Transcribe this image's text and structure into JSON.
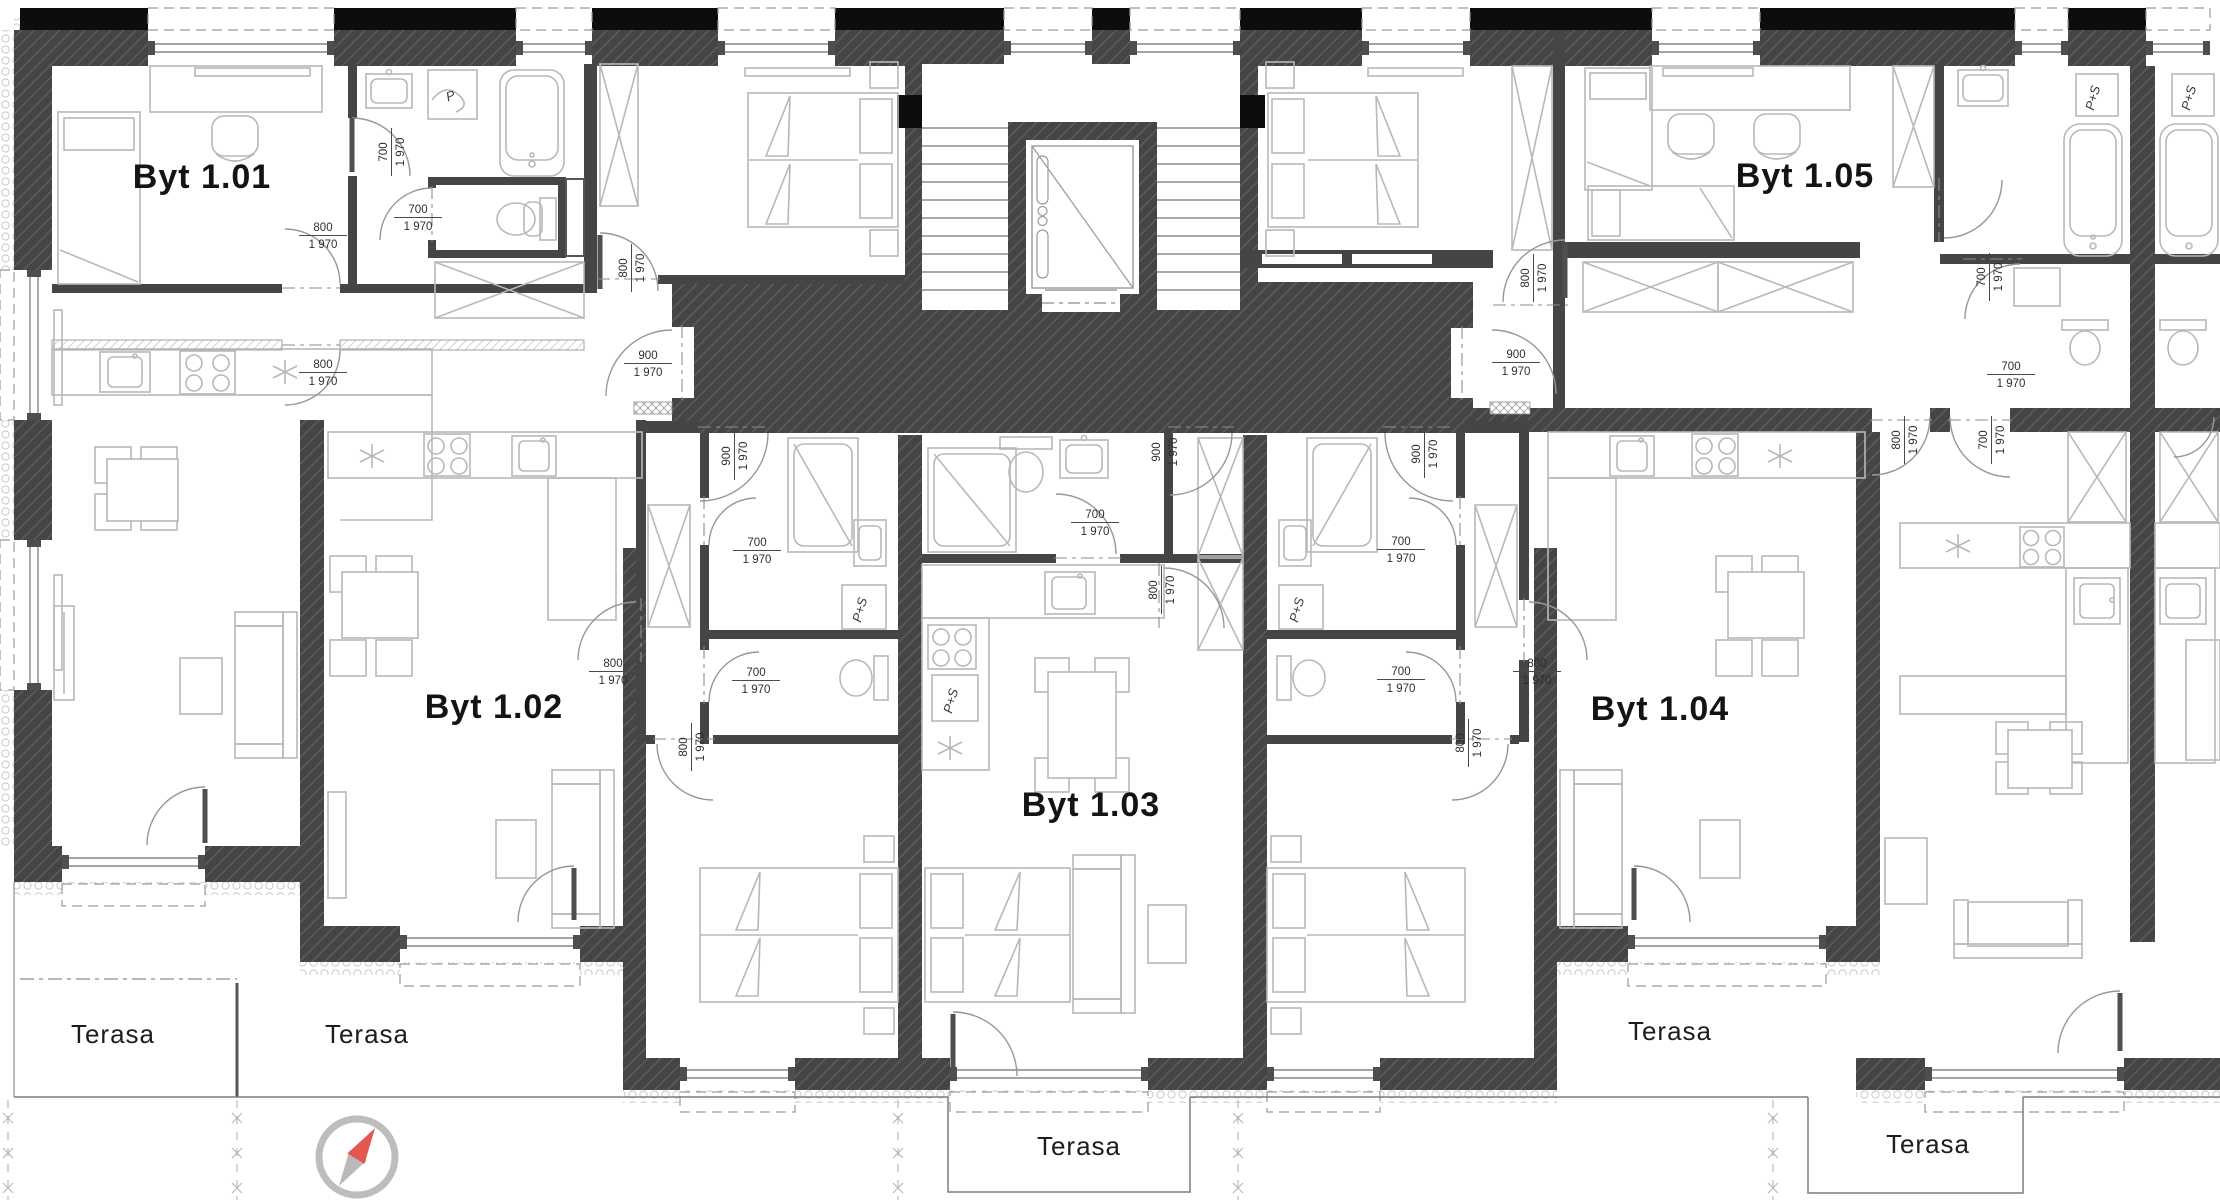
{
  "drawing": {
    "kind": "architectural floor plan",
    "floor_label": "1",
    "units": "mm"
  },
  "colors": {
    "wall_dark": "#454545",
    "wall_hatch": "#616161",
    "black_strip": "#0d0d0d",
    "thin_line": "#b8b8b8",
    "door_line": "#979797",
    "dim_text": "#2e2e2e",
    "compass_ring": "#bdbdbd",
    "compass_north": "#e2584e",
    "compass_south": "#b9b9b9"
  },
  "apartments": [
    {
      "id": "1.01",
      "label": "Byt 1.01",
      "x": 202,
      "y": 188
    },
    {
      "id": "1.02",
      "label": "Byt 1.02",
      "x": 494,
      "y": 718
    },
    {
      "id": "1.03",
      "label": "Byt 1.03",
      "x": 1091,
      "y": 816
    },
    {
      "id": "1.04",
      "label": "Byt 1.04",
      "x": 1660,
      "y": 720
    },
    {
      "id": "1.05",
      "label": "Byt 1.05",
      "x": 1805,
      "y": 187
    }
  ],
  "terraces": [
    {
      "label": "Terasa",
      "x": 113,
      "y": 1043
    },
    {
      "label": "Terasa",
      "x": 367,
      "y": 1043
    },
    {
      "label": "Terasa",
      "x": 1079,
      "y": 1155
    },
    {
      "label": "Terasa",
      "x": 1670,
      "y": 1040
    },
    {
      "label": "Terasa",
      "x": 1928,
      "y": 1153
    }
  ],
  "door_dimensions": [
    {
      "w": "700",
      "h": "1 970",
      "x": 390,
      "y": 152,
      "o": "v"
    },
    {
      "w": "700",
      "h": "1 970",
      "x": 418,
      "y": 216,
      "o": "h"
    },
    {
      "w": "800",
      "h": "1 970",
      "x": 323,
      "y": 234,
      "o": "h"
    },
    {
      "w": "800",
      "h": "1 970",
      "x": 323,
      "y": 371,
      "o": "h"
    },
    {
      "w": "800",
      "h": "1 970",
      "x": 630,
      "y": 268,
      "o": "v"
    },
    {
      "w": "900",
      "h": "1 970",
      "x": 648,
      "y": 362,
      "o": "h"
    },
    {
      "w": "900",
      "h": "1 970",
      "x": 733,
      "y": 456,
      "o": "v"
    },
    {
      "w": "700",
      "h": "1 970",
      "x": 757,
      "y": 549,
      "o": "h"
    },
    {
      "w": "800",
      "h": "1 970",
      "x": 613,
      "y": 670,
      "o": "h"
    },
    {
      "w": "700",
      "h": "1 970",
      "x": 756,
      "y": 679,
      "o": "h"
    },
    {
      "w": "800",
      "h": "1 970",
      "x": 690,
      "y": 747,
      "o": "v"
    },
    {
      "w": "900",
      "h": "1 970",
      "x": 1163,
      "y": 452,
      "o": "v"
    },
    {
      "w": "700",
      "h": "1 970",
      "x": 1095,
      "y": 521,
      "o": "h"
    },
    {
      "w": "800",
      "h": "1 970",
      "x": 1160,
      "y": 590,
      "o": "v"
    },
    {
      "w": "900",
      "h": "1 970",
      "x": 1423,
      "y": 454,
      "o": "v"
    },
    {
      "w": "700",
      "h": "1 970",
      "x": 1401,
      "y": 548,
      "o": "h"
    },
    {
      "w": "700",
      "h": "1 970",
      "x": 1401,
      "y": 678,
      "o": "h"
    },
    {
      "w": "800",
      "h": "1 970",
      "x": 1537,
      "y": 670,
      "o": "h"
    },
    {
      "w": "800",
      "h": "1 970",
      "x": 1467,
      "y": 743,
      "o": "v"
    },
    {
      "w": "800",
      "h": "1 970",
      "x": 1532,
      "y": 278,
      "o": "v"
    },
    {
      "w": "900",
      "h": "1 970",
      "x": 1516,
      "y": 361,
      "o": "h"
    },
    {
      "w": "800",
      "h": "1 970",
      "x": 1903,
      "y": 440,
      "o": "v"
    },
    {
      "w": "700",
      "h": "1 970",
      "x": 1990,
      "y": 440,
      "o": "v"
    },
    {
      "w": "700",
      "h": "1 970",
      "x": 1988,
      "y": 277,
      "o": "v"
    },
    {
      "w": "700",
      "h": "1 970",
      "x": 2011,
      "y": 373,
      "o": "h"
    }
  ],
  "appliances": [
    {
      "label": "P",
      "x": 452,
      "y": 100,
      "r": -20
    },
    {
      "label": "P+S",
      "x": 864,
      "y": 611,
      "r": -75
    },
    {
      "label": "P+S",
      "x": 955,
      "y": 702,
      "r": -75
    },
    {
      "label": "P+S",
      "x": 1301,
      "y": 611,
      "r": -75
    },
    {
      "label": "P+S",
      "x": 2097,
      "y": 99,
      "r": -75
    },
    {
      "label": "P+S",
      "x": 2193,
      "y": 99,
      "r": -75
    }
  ]
}
